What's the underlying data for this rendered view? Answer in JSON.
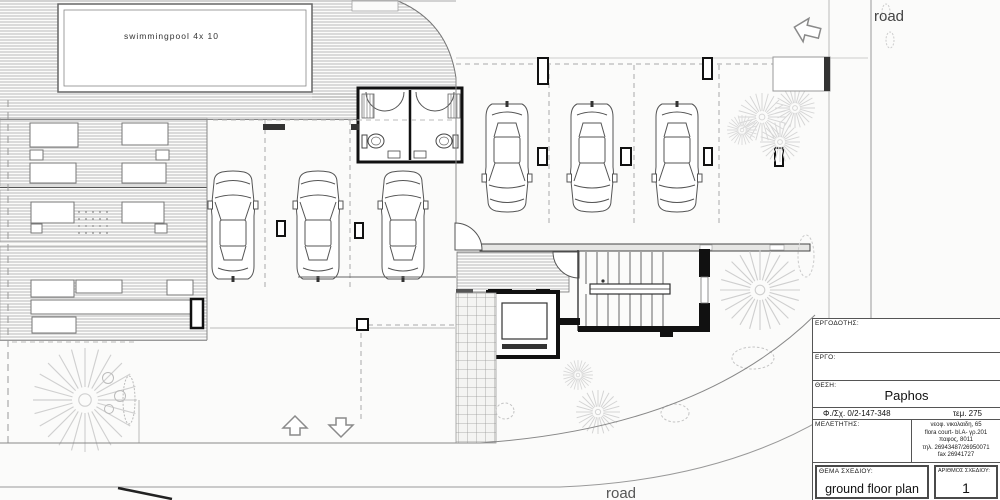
{
  "drawing": {
    "type": "architectural-site-plan",
    "labels": {
      "pool": "swimmingpool  4x 10",
      "road_top": "road",
      "road_bottom": "road"
    },
    "features": [
      "swimming pool deck",
      "sun terraces",
      "wc pavilion",
      "parking rows with 6 cars",
      "stair and elevator core",
      "tiled walkway",
      "trees and shrubs",
      "site boundary with curved road"
    ]
  },
  "title_block": {
    "employer_label": "ΕΡΓΟΔΟΤΗΣ:",
    "project_label": "ΕΡΓΟ:",
    "location_label": "ΘΕΣΗ:",
    "location_value": "Paphos",
    "sheet_ref": "Φ./Σχ. 0/2-147-348",
    "plot_ref": "τεμ. 275",
    "designer_label": "ΜΕΛΕΤΗΤΗΣ:",
    "designer_address_lines": [
      "νεοφ. νικολαιδη, 65",
      "flora court- bl.A- γρ.201",
      "παφος, 8011",
      "τηλ. 26943487/26950071",
      "fax 26941727"
    ],
    "subject_label": "ΘΕΜΑ ΣΧΕΔΙΟΥ:",
    "subject_value": "ground floor plan",
    "number_label": "ΑΡΙΘΜΟΣ ΣΧΕΔΙΟΥ:",
    "number_value": "1"
  },
  "colors": {
    "wall": "#1a1a1a",
    "line": "#555555",
    "light_line": "#999999",
    "dash": "#aaaaaa",
    "tree": "#d0d0d0",
    "paper": "#fbfbfa"
  }
}
